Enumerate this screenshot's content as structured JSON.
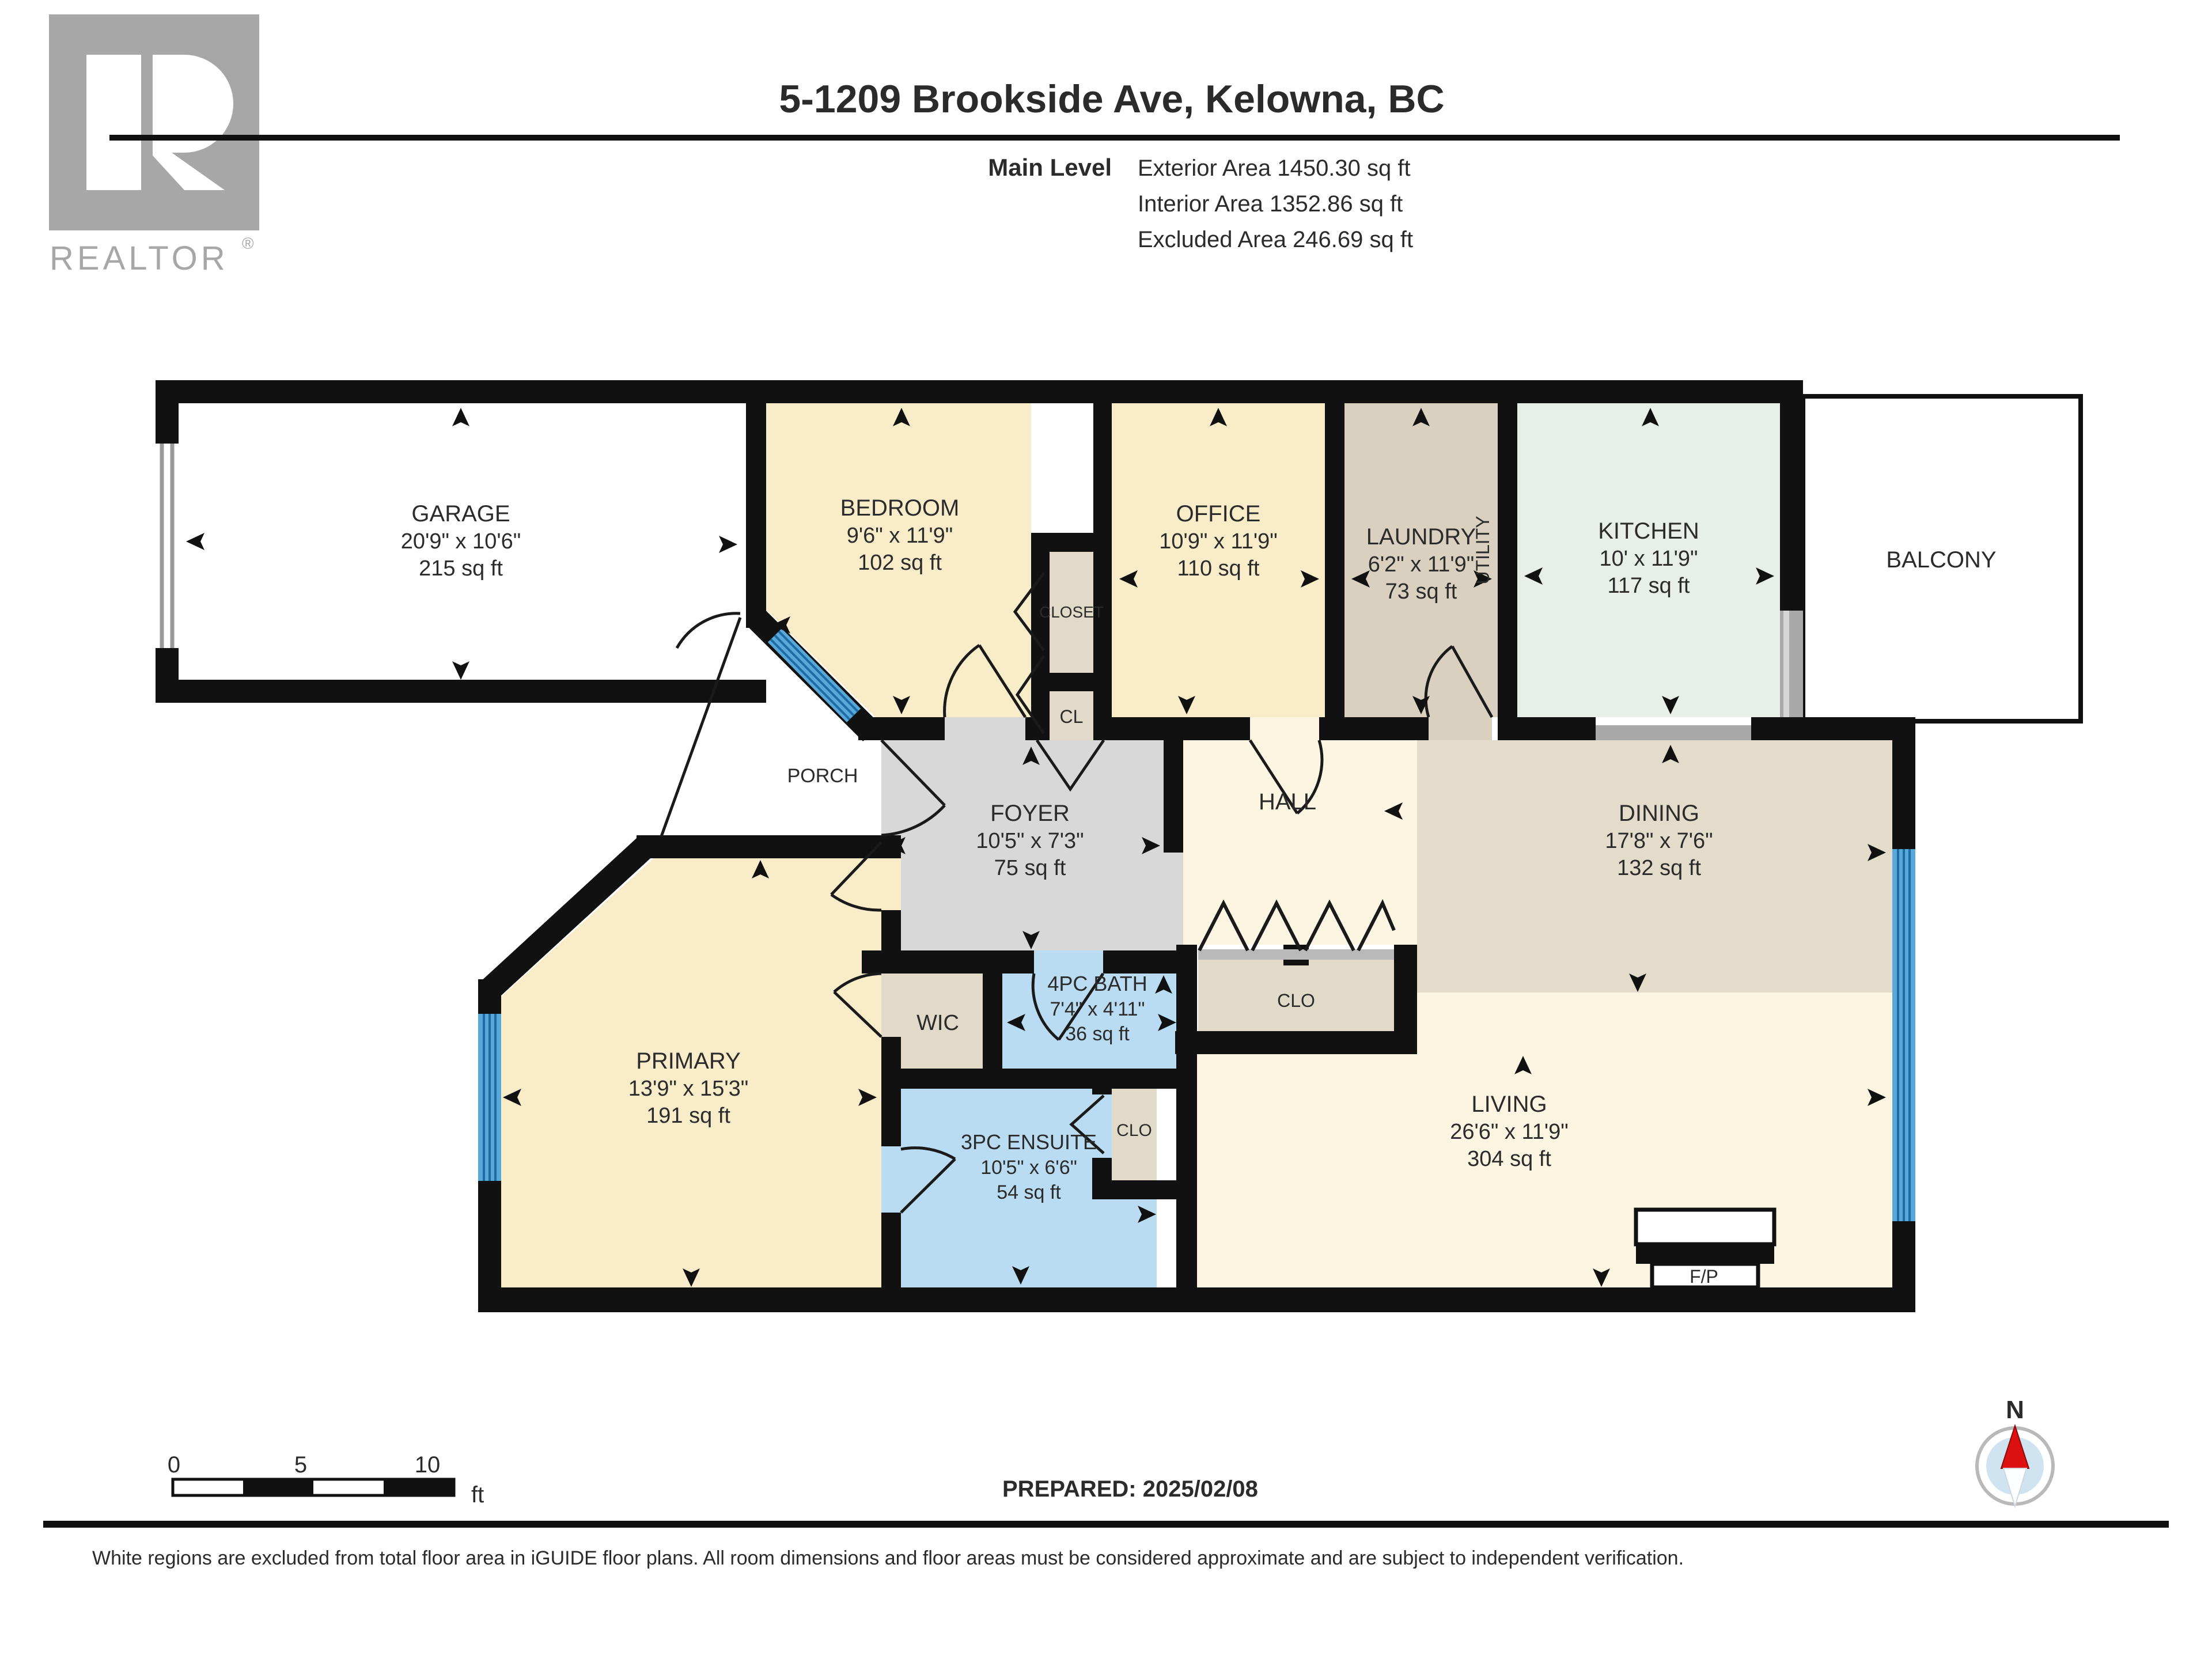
{
  "header": {
    "title": "5-1209 Brookside Ave, Kelowna, BC",
    "level_label": "Main Level",
    "stats": [
      "Exterior Area 1450.30 sq ft",
      "Interior Area 1352.86 sq ft",
      "Excluded Area 246.69 sq ft"
    ],
    "logo": {
      "brand": "REALTOR",
      "registered": "®"
    }
  },
  "rooms": {
    "garage": {
      "name": "GARAGE",
      "dims": "20'9\" x 10'6\"",
      "area": "215 sq ft"
    },
    "bedroom": {
      "name": "BEDROOM",
      "dims": "9'6\" x 11'9\"",
      "area": "102 sq ft"
    },
    "closet": {
      "name": "CLOSET"
    },
    "cl": {
      "name": "CL"
    },
    "office": {
      "name": "OFFICE",
      "dims": "10'9\" x 11'9\"",
      "area": "110 sq ft"
    },
    "laundry": {
      "name": "LAUNDRY",
      "dims": "6'2\" x 11'9\"",
      "area": "73 sq ft"
    },
    "utility": {
      "name": "UTILITY"
    },
    "kitchen": {
      "name": "KITCHEN",
      "dims": "10' x 11'9\"",
      "area": "117 sq ft"
    },
    "balcony": {
      "name": "BALCONY"
    },
    "porch": {
      "name": "PORCH"
    },
    "foyer": {
      "name": "FOYER",
      "dims": "10'5\" x 7'3\"",
      "area": "75 sq ft"
    },
    "hall": {
      "name": "HALL"
    },
    "clo_hall": {
      "name": "CLO"
    },
    "dining": {
      "name": "DINING",
      "dims": "17'8\" x 7'6\"",
      "area": "132 sq ft"
    },
    "living": {
      "name": "LIVING",
      "dims": "26'6\" x 11'9\"",
      "area": "304 sq ft"
    },
    "primary": {
      "name": "PRIMARY",
      "dims": "13'9\" x 15'3\"",
      "area": "191 sq ft"
    },
    "wic": {
      "name": "WIC"
    },
    "bath": {
      "name": "4PC BATH",
      "dims": "7'4\" x 4'11\"",
      "area": "36 sq ft"
    },
    "ensuite": {
      "name": "3PC ENSUITE",
      "dims": "10'5\" x 6'6\"",
      "area": "54 sq ft"
    },
    "clo_ensuite": {
      "name": "CLO"
    },
    "fireplace": {
      "name": "F/P"
    }
  },
  "footer": {
    "prepared": "PREPARED: 2025/02/08",
    "disclaimer": "White regions are excluded from total floor area in iGUIDE floor plans. All room dimensions and floor areas must be considered approximate and are subject to independent verification."
  },
  "scale_bar": {
    "ticks": [
      "0",
      "5",
      "10"
    ],
    "unit": "ft"
  },
  "compass": {
    "north_label": "N"
  },
  "colors": {
    "wall": "#111111",
    "cream_room": "#f8ecc9",
    "pale_room": "#fbf5e1",
    "tan_room": "#d9d0bf",
    "closet_tan": "#e2dac9",
    "dining_tan": "#e4dcca",
    "kitchen_green": "#e7efe8",
    "foyer_gray": "#d8d8d8",
    "bath_blue": "#b9dcf2",
    "window_blue": "#58a9da",
    "window_stripe": "#1d6ca3",
    "slider_gray": "#a9a9a9",
    "compass_red": "#dd1111",
    "compass_blue": "#cfe3f1",
    "logo_gray": "#a7a7a7"
  }
}
